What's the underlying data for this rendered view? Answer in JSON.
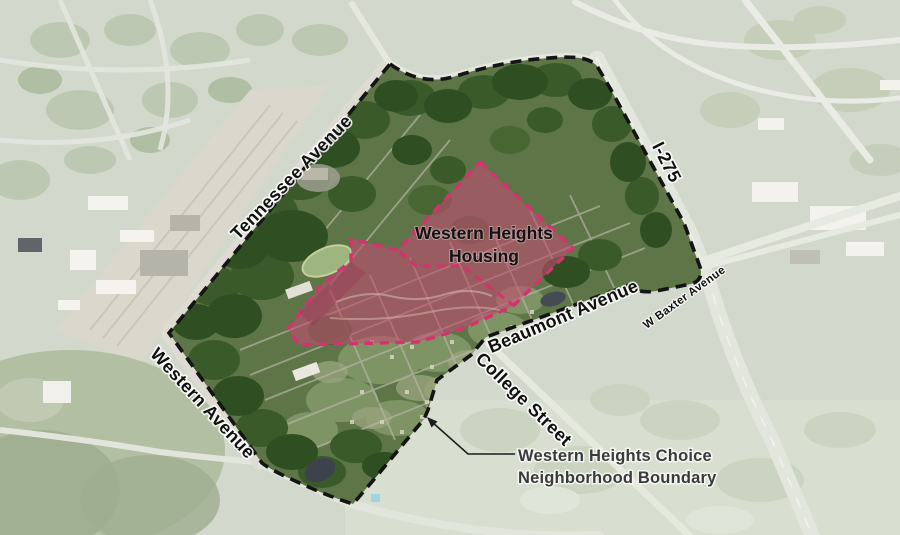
{
  "map": {
    "labels": {
      "streets": [
        {
          "name": "tennessee-avenue",
          "text": "Tennessee Avenue"
        },
        {
          "name": "western-avenue",
          "text": "Western Avenue"
        },
        {
          "name": "beaumont-avenue",
          "text": "Beaumont Avenue"
        },
        {
          "name": "college-street",
          "text": "College Street"
        },
        {
          "name": "interstate-275",
          "text": "I-275"
        },
        {
          "name": "w-baxter-avenue",
          "text": "W Baxter Avenue"
        }
      ],
      "housing_area": {
        "line1": "Western Heights",
        "line2": "Housing"
      },
      "annotation": {
        "line1": "Western Heights Choice",
        "line2": "Neighborhood Boundary"
      }
    },
    "colors": {
      "neighborhood_boundary": "#141414",
      "housing_fill": "#c44a74",
      "housing_outline": "#d3336e",
      "annotation_line": "#1c1c1c"
    }
  }
}
